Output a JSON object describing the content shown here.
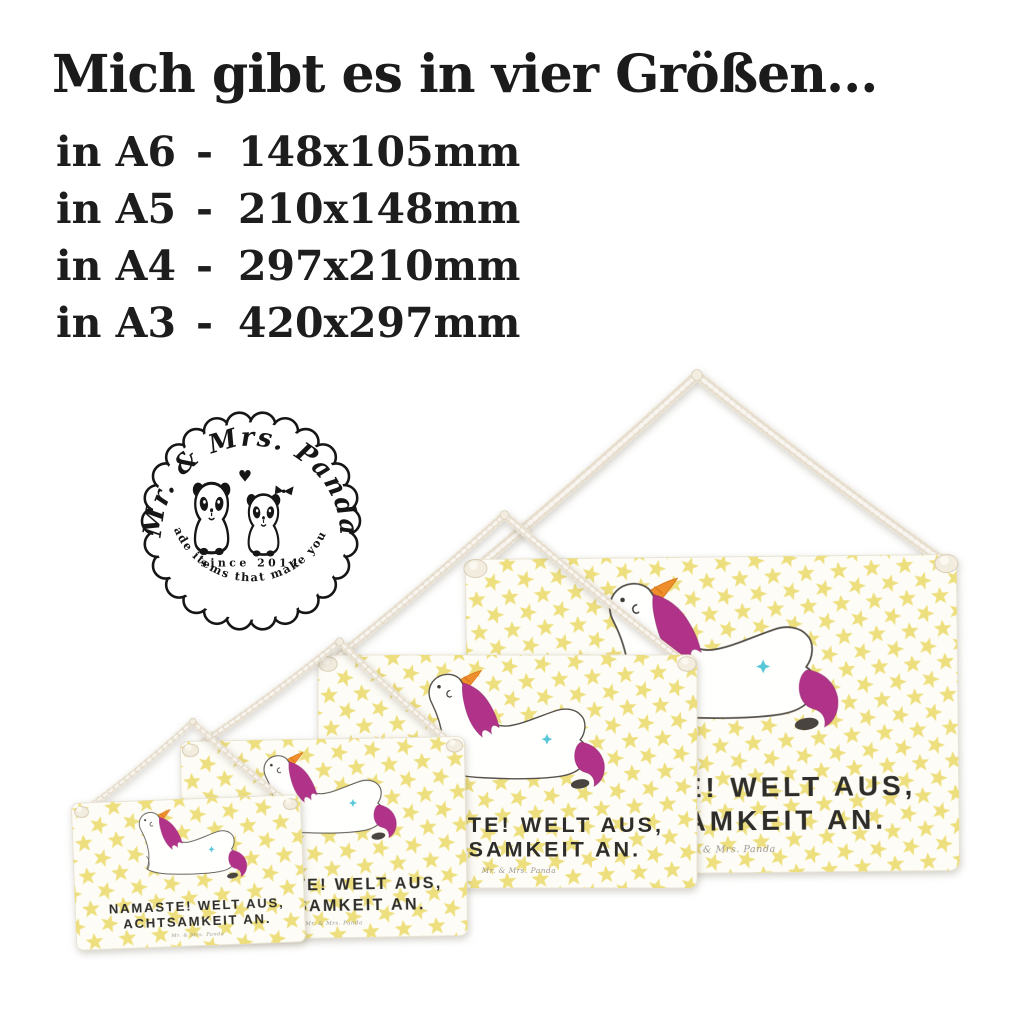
{
  "header": {
    "title": "Mich gibt es in vier Größen...",
    "sizes": {
      "separator": "-",
      "items": [
        {
          "label": "in A6",
          "dims": "148x105mm"
        },
        {
          "label": "in A5",
          "dims": "210x148mm"
        },
        {
          "label": "in A4",
          "dims": "297x210mm"
        },
        {
          "label": "in A3",
          "dims": "420x297mm"
        }
      ]
    }
  },
  "logo": {
    "brand": "Mr. & Mrs. Panda",
    "since": "since 2014",
    "tagline": "Handmade items that make you happy!",
    "heart_glyph": "♥"
  },
  "sign": {
    "line1": "NAMASTE! WELT AUS,",
    "line2": "ACHTSAMKEIT AN.",
    "brand_signature": "Mr. & Mrs. Panda"
  },
  "colors": {
    "star_yellow": "#EDDD75",
    "board_white": "#FDFCF6",
    "rope_cream": "#F3EDE0",
    "rope_shade": "#D9CEB9",
    "ink": "#2E2D29",
    "mane_magenta": "#B13389",
    "horn_orange": "#EF8E2D",
    "hip_star_teal": "#57C7D8",
    "outline_gray": "#57524C",
    "logo_black": "#161616",
    "brand_gray": "#9B978D"
  }
}
